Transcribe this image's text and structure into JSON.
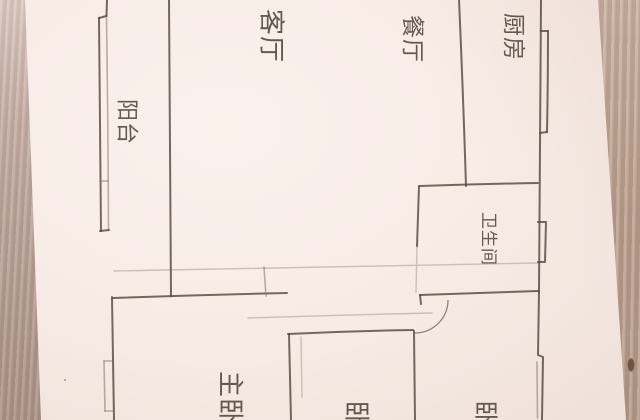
{
  "scene": {
    "description_visible_text_only": true,
    "rooms": {
      "living": {
        "label": "客厅"
      },
      "dining": {
        "label": "餐厅"
      },
      "kitchen": {
        "label": "厨房"
      },
      "balcony": {
        "label": "阳台"
      },
      "bathroom": {
        "label": "卫生间"
      },
      "master_bedroom": {
        "label": "主卧"
      },
      "bedroom_middle": {
        "label": "卧"
      },
      "bedroom_right": {
        "label": "卧"
      }
    },
    "colors": {
      "paper": "#f6eae4",
      "ink": "#57493e",
      "faint_line": "#c9b8ae",
      "wood_left": "#b29a90",
      "wood_right": "#bba08e",
      "wood_knot": "#6f523f"
    }
  }
}
